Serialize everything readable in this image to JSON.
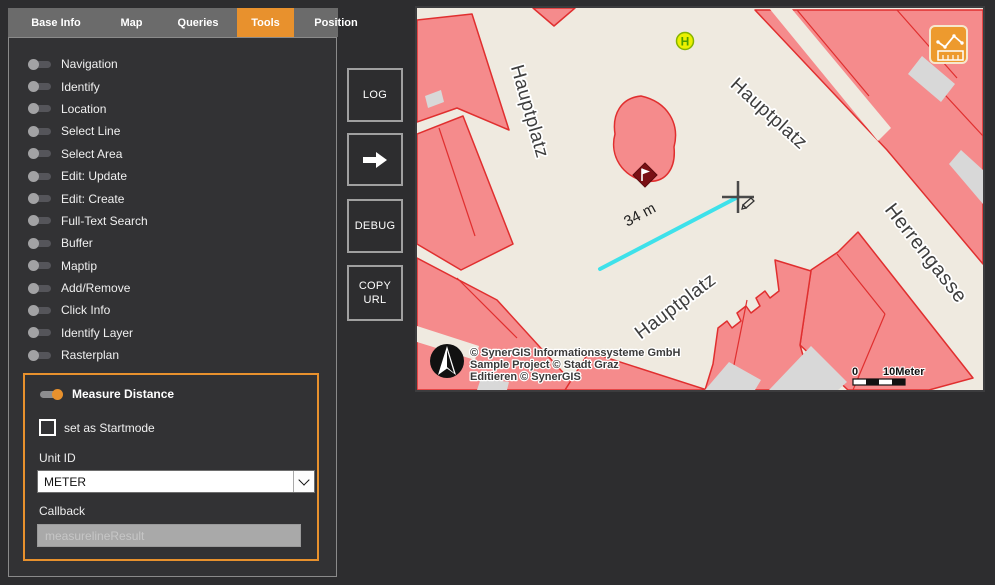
{
  "tabs": [
    {
      "label": "Base Info",
      "active": false
    },
    {
      "label": "Map",
      "active": false
    },
    {
      "label": "Queries",
      "active": false
    },
    {
      "label": "Tools",
      "active": true
    },
    {
      "label": "Position",
      "active": false
    }
  ],
  "sidebar": {
    "tools": [
      "Navigation",
      "Identify",
      "Location",
      "Select Line",
      "Select Area",
      "Edit: Update",
      "Edit: Create",
      "Full-Text Search",
      "Buffer",
      "Maptip",
      "Add/Remove",
      "Click Info",
      "Identify Layer",
      "Rasterplan"
    ]
  },
  "measure_panel": {
    "title": "Measure Distance",
    "toggle_state": "on",
    "startmode_label": "set as Startmode",
    "startmode_checked": false,
    "unit_label": "Unit ID",
    "unit_value": "METER",
    "callback_label": "Callback",
    "callback_value": "measurelineResult"
  },
  "action_buttons": {
    "log": "LOG",
    "forward_icon": "right-arrow",
    "debug": "DEBUG",
    "copy_url": "COPY URL"
  },
  "map": {
    "street_labels": [
      {
        "text": "Hauptplatz"
      },
      {
        "text": "Hauptplatz"
      },
      {
        "text": "Hauptplatz"
      },
      {
        "text": "Herrengasse"
      }
    ],
    "measurement": {
      "distance_label": "34 m"
    },
    "bus_stop_letter": "H",
    "attribution": [
      "© SynerGIS Informationssysteme GmbH",
      "Sample Project © Stadt Graz",
      "Editieren © SynerGIS"
    ],
    "scale_bar": {
      "start": "0",
      "end": "10Meter"
    }
  },
  "colors": {
    "accent": "#e8912d",
    "building_fill": "#f58b8c",
    "building_outline": "#e02f2f",
    "street": "#efeae0",
    "gray_building": "#d8d8d8",
    "measure_line": "#3ee1ea",
    "bus_stop_fill": "#ebf000",
    "bus_stop_green": "#6fa800",
    "flag_marker": "#7a1015"
  }
}
